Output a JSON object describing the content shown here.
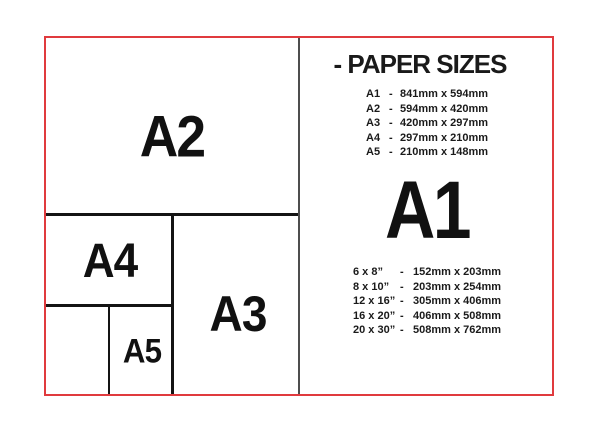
{
  "colors": {
    "frame_red": "#e03a3e",
    "divider_gray": "#4d4d4d",
    "line_black": "#141414",
    "text_black": "#1a1a1a"
  },
  "diagram": {
    "boxes": [
      {
        "label": "A2"
      },
      {
        "label": "A4"
      },
      {
        "label": "A3"
      },
      {
        "label": "A5"
      }
    ]
  },
  "panel": {
    "title": "- PAPER SIZES",
    "separator": "-",
    "featured_size": "A1",
    "a_sizes": [
      {
        "name": "A1",
        "dims": "841mm x 594mm"
      },
      {
        "name": "A2",
        "dims": "594mm x 420mm"
      },
      {
        "name": "A3",
        "dims": "420mm x 297mm"
      },
      {
        "name": "A4",
        "dims": "297mm x 210mm"
      },
      {
        "name": "A5",
        "dims": "210mm x 148mm"
      }
    ],
    "inch_sizes": [
      {
        "name": "6 x 8”",
        "dims": "152mm x 203mm"
      },
      {
        "name": "8 x 10”",
        "dims": "203mm x 254mm"
      },
      {
        "name": "12 x 16”",
        "dims": "305mm x 406mm"
      },
      {
        "name": "16 x 20”",
        "dims": "406mm x 508mm"
      },
      {
        "name": "20 x 30”",
        "dims": "508mm x 762mm"
      }
    ]
  }
}
